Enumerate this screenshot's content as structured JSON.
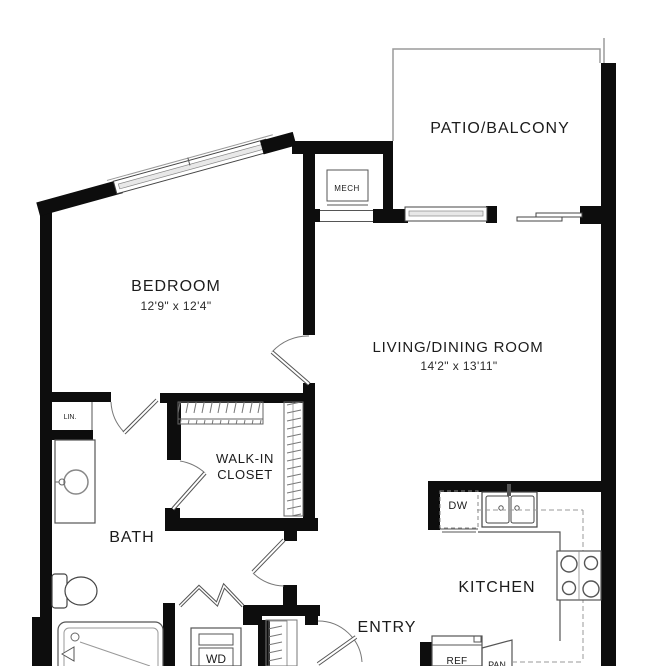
{
  "rooms": {
    "bedroom": {
      "label": "BEDROOM",
      "dims": "12'9\" x 12'4\""
    },
    "living_dining": {
      "label": "LIVING/DINING ROOM",
      "dims": "14'2\" x 13'11\""
    },
    "patio": {
      "label": "PATIO/BALCONY"
    },
    "kitchen": {
      "label": "KITCHEN"
    },
    "bath": {
      "label": "BATH"
    },
    "entry": {
      "label": "ENTRY"
    },
    "walk_in_closet": {
      "label_line1": "WALK-IN",
      "label_line2": "CLOSET"
    },
    "mech": {
      "label": "MECH"
    },
    "linen": {
      "label": "LIN."
    }
  },
  "appliances": {
    "dishwasher": "DW",
    "washer_dryer": "WD",
    "refrigerator": "REF",
    "pantry": "PAN"
  },
  "colors": {
    "wall": "#0d0d0d",
    "fixture_line": "#555555",
    "light_line": "#9a9a9a",
    "background": "#ffffff"
  }
}
